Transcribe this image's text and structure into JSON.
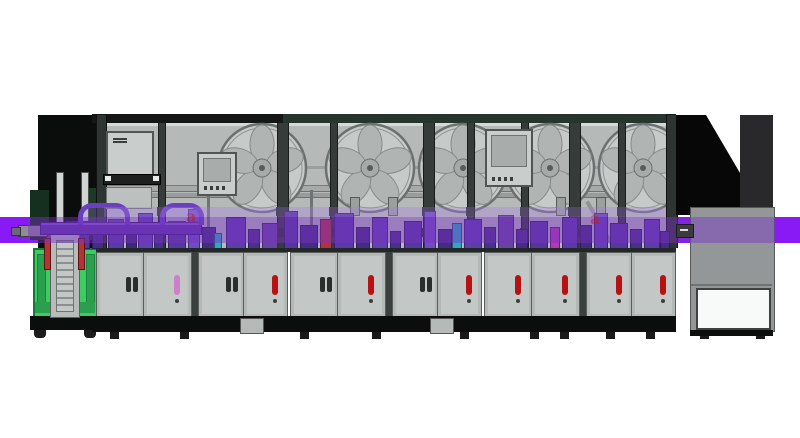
{
  "scene": {
    "watermarks": [
      {
        "text": "a",
        "x": 186,
        "y": 209
      },
      {
        "text": "a",
        "x": 590,
        "y": 211
      }
    ],
    "colors": {
      "highlight_band": "#8a1af5",
      "band_tint_over_machine": "rgba(122,48,200,0.45)",
      "cabinet_green": "#3ecb63",
      "machine_gray": "#c3c7c6",
      "glass_gray": "#b5bab9",
      "frame_dark": "#363c3a",
      "indicator_red": "#b51212",
      "indicator_pink": "#cf7fc9",
      "background": "#ffffff"
    }
  },
  "machine": {
    "reel_geometry": {
      "cy": 168,
      "r": 44
    },
    "reels": [
      {
        "cx": 262
      },
      {
        "cx": 370
      },
      {
        "cx": 463
      },
      {
        "cx": 550
      },
      {
        "cx": 643
      }
    ],
    "posts": [
      {
        "x": 158,
        "w": 6
      },
      {
        "x": 277,
        "w": 10
      },
      {
        "x": 330,
        "w": 6
      },
      {
        "x": 423,
        "w": 10
      },
      {
        "x": 467,
        "w": 6
      },
      {
        "x": 521,
        "w": 6
      },
      {
        "x": 569,
        "w": 10
      },
      {
        "x": 618,
        "w": 6
      }
    ],
    "monitors": [
      {
        "x": 106,
        "y": 131,
        "w": 44,
        "h": 42,
        "style": "label"
      },
      {
        "x": 197,
        "y": 152,
        "w": 36,
        "h": 40,
        "style": "buttons"
      },
      {
        "x": 485,
        "y": 129,
        "w": 44,
        "h": 54,
        "style": "buttons"
      }
    ],
    "door_groups": [
      {
        "start": 96,
        "fixtures": [
          "handle",
          "ind-pink",
          "handle",
          "ind-red"
        ]
      },
      {
        "start": 290,
        "fixtures": [
          "handle",
          "ind-red",
          "handle",
          "ind-red"
        ]
      },
      {
        "start": 484,
        "fixtures": [
          "ind-red",
          "ind-red",
          "ind-red",
          "ind-red"
        ]
      }
    ],
    "stubs": [
      350,
      388,
      556,
      596
    ],
    "poles": [
      207,
      310
    ],
    "feet_blocks": [
      240,
      430
    ],
    "feet_small": [
      110,
      180,
      300,
      372,
      460,
      530,
      560,
      606,
      646,
      700,
      756
    ],
    "stations": [
      {
        "x": 46,
        "w": 16,
        "h": 20,
        "c": "#6b47b3"
      },
      {
        "x": 66,
        "w": 22,
        "h": 26,
        "c": "#55379c"
      },
      {
        "x": 92,
        "w": 10,
        "h": 16,
        "c": "#472c85"
      },
      {
        "x": 108,
        "w": 14,
        "h": 28,
        "c": "#5a3aa6"
      },
      {
        "x": 126,
        "w": 9,
        "h": 18,
        "c": "#3f2a77"
      },
      {
        "x": 138,
        "w": 13,
        "h": 34,
        "c": "#6241b0"
      },
      {
        "x": 154,
        "w": 8,
        "h": 22,
        "c": "#4a3188"
      },
      {
        "x": 168,
        "w": 16,
        "h": 26,
        "c": "#56389e"
      },
      {
        "x": 188,
        "w": 10,
        "h": 38,
        "c": "#6f4cc0"
      },
      {
        "x": 202,
        "w": 12,
        "h": 20,
        "c": "#432d80"
      },
      {
        "x": 214,
        "w": 6,
        "h": 14,
        "c": "#2ea8bd"
      },
      {
        "x": 226,
        "w": 18,
        "h": 30,
        "c": "#5d3da8"
      },
      {
        "x": 248,
        "w": 10,
        "h": 18,
        "c": "#4a3188"
      },
      {
        "x": 262,
        "w": 14,
        "h": 24,
        "c": "#66449f"
      },
      {
        "x": 284,
        "w": 12,
        "h": 36,
        "c": "#55379c"
      },
      {
        "x": 300,
        "w": 16,
        "h": 22,
        "c": "#472c85"
      },
      {
        "x": 320,
        "w": 10,
        "h": 28,
        "c": "#b03440"
      },
      {
        "x": 334,
        "w": 18,
        "h": 34,
        "c": "#5a3aa6"
      },
      {
        "x": 356,
        "w": 12,
        "h": 20,
        "c": "#432d80"
      },
      {
        "x": 372,
        "w": 14,
        "h": 30,
        "c": "#6241b0"
      },
      {
        "x": 390,
        "w": 9,
        "h": 16,
        "c": "#4a3188"
      },
      {
        "x": 404,
        "w": 16,
        "h": 26,
        "c": "#56389e"
      },
      {
        "x": 424,
        "w": 10,
        "h": 36,
        "c": "#6f4cc0"
      },
      {
        "x": 438,
        "w": 12,
        "h": 18,
        "c": "#432d80"
      },
      {
        "x": 452,
        "w": 8,
        "h": 24,
        "c": "#2ea8bd"
      },
      {
        "x": 464,
        "w": 16,
        "h": 28,
        "c": "#5d3da8"
      },
      {
        "x": 484,
        "w": 10,
        "h": 20,
        "c": "#4a3188"
      },
      {
        "x": 498,
        "w": 14,
        "h": 32,
        "c": "#66449f"
      },
      {
        "x": 516,
        "w": 10,
        "h": 18,
        "c": "#472c85"
      },
      {
        "x": 530,
        "w": 16,
        "h": 26,
        "c": "#55379c"
      },
      {
        "x": 550,
        "w": 8,
        "h": 20,
        "c": "#b23ab0"
      },
      {
        "x": 562,
        "w": 14,
        "h": 30,
        "c": "#5a3aa6"
      },
      {
        "x": 580,
        "w": 10,
        "h": 22,
        "c": "#432d80"
      },
      {
        "x": 594,
        "w": 12,
        "h": 34,
        "c": "#6241b0"
      },
      {
        "x": 610,
        "w": 16,
        "h": 24,
        "c": "#56389e"
      },
      {
        "x": 630,
        "w": 10,
        "h": 18,
        "c": "#4a3188"
      },
      {
        "x": 644,
        "w": 14,
        "h": 28,
        "c": "#5d3da8"
      },
      {
        "x": 660,
        "w": 8,
        "h": 16,
        "c": "#472c85"
      }
    ]
  }
}
